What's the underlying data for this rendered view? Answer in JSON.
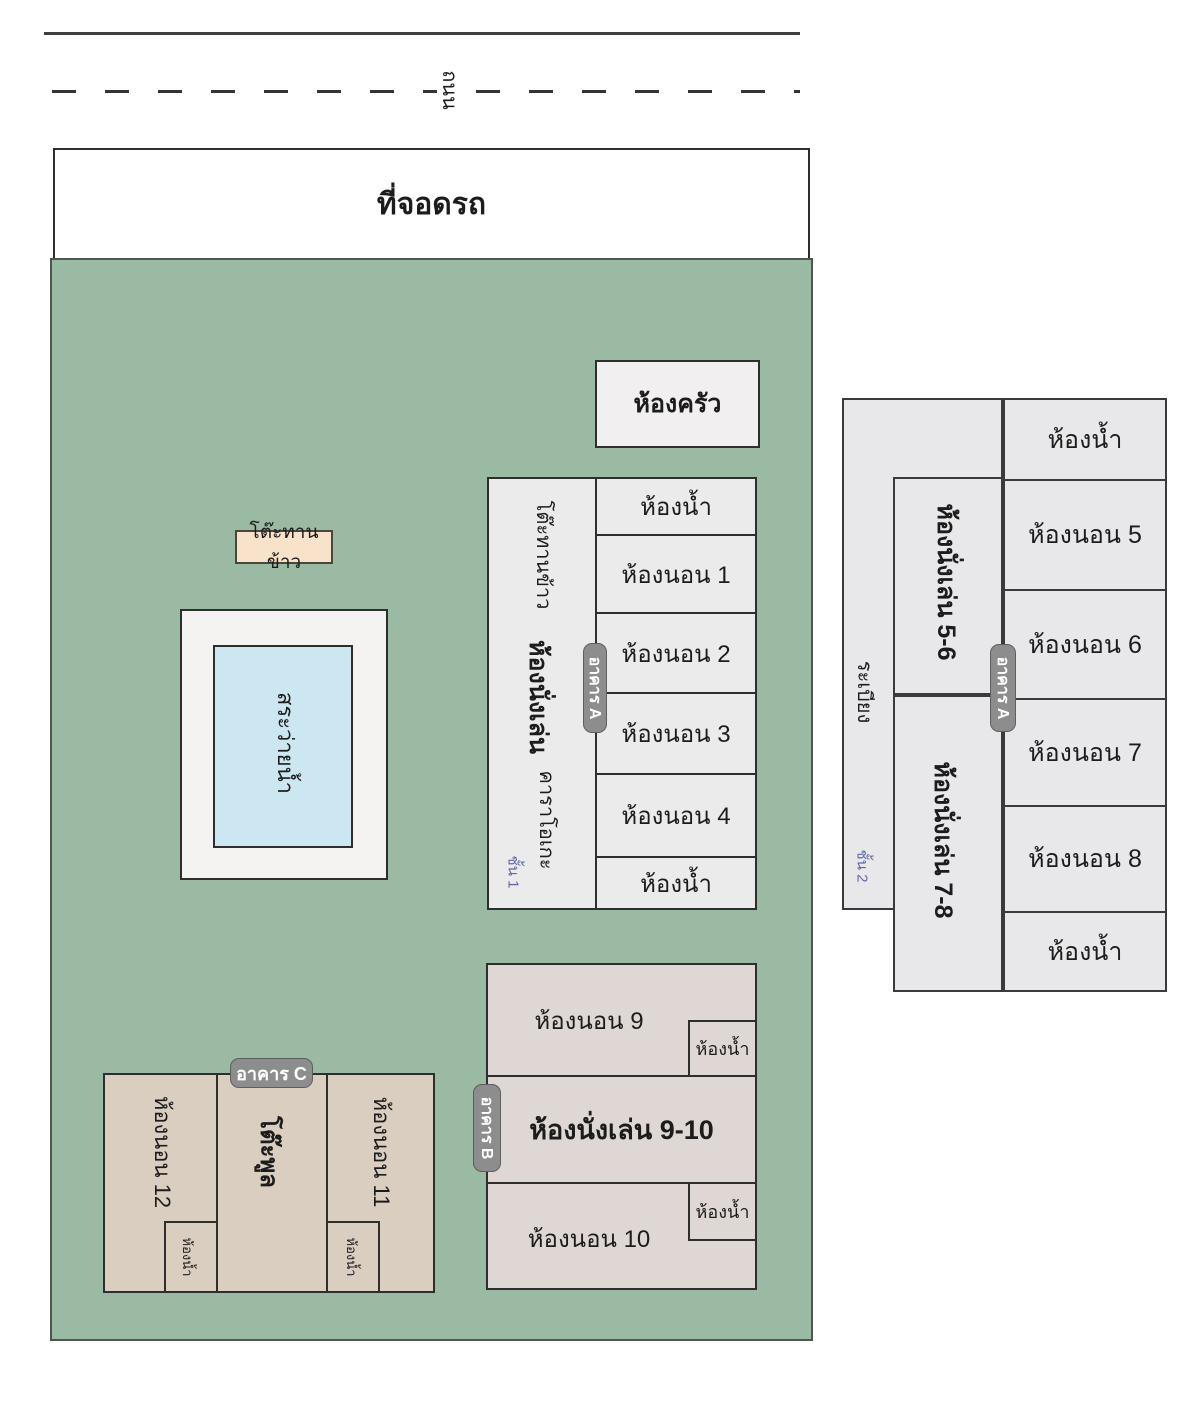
{
  "road": {
    "label": "ถนน"
  },
  "parking": {
    "label": "ที่จอดรถ"
  },
  "kitchen": {
    "label": "ห้องครัว"
  },
  "dining_table_outdoor": {
    "label": "โต๊ะทานข้าว"
  },
  "pool": {
    "label": "สระว่ายน้ำ"
  },
  "building_a_floor1": {
    "badge": "อาคาร A",
    "floor_label": "ชั้น 1",
    "dining_table": "โต๊ะทานข้าว",
    "living_room": "ห้องนั่งเล่น",
    "karaoke": "คาราโอเกะ",
    "rooms": [
      "ห้องน้ำ",
      "ห้องนอน 1",
      "ห้องนอน 2",
      "ห้องนอน 3",
      "ห้องนอน 4",
      "ห้องน้ำ"
    ]
  },
  "building_b": {
    "badge": "อาคาร B",
    "bedroom9": "ห้องนอน 9",
    "bath9": "ห้องน้ำ",
    "living": "ห้องนั่งเล่น 9-10",
    "bath10": "ห้องน้ำ",
    "bedroom10": "ห้องนอน 10"
  },
  "building_c": {
    "badge": "อาคาร C",
    "bedroom12": "ห้องนอน 12",
    "bath12": "ห้องน้ำ",
    "pool_table": "โต๊ะพูล",
    "bedroom11": "ห้องนอน 11",
    "bath11": "ห้องน้ำ"
  },
  "building_a_floor2": {
    "badge": "อาคาร A",
    "floor_label": "ชั้น 2",
    "balcony": "ระเบียง",
    "living56": "ห้องนั่งเล่น 5-6",
    "living78": "ห้องนั่งเล่น 7-8",
    "rooms": [
      "ห้องน้ำ",
      "ห้องนอน 5",
      "ห้องนอน 6",
      "ห้องนอน 7",
      "ห้องนอน 8",
      "ห้องน้ำ"
    ]
  },
  "colors": {
    "green": "#9abaa4",
    "bldga": "#ebebeb",
    "bldga2": "#e8e8ea",
    "bldgb": "#ded7d3",
    "bldgc": "#d9cec0",
    "pool": "#cde7f2",
    "dining": "#f8e2c9",
    "badge": "#8d8d8d",
    "floor": "#6767a8"
  }
}
